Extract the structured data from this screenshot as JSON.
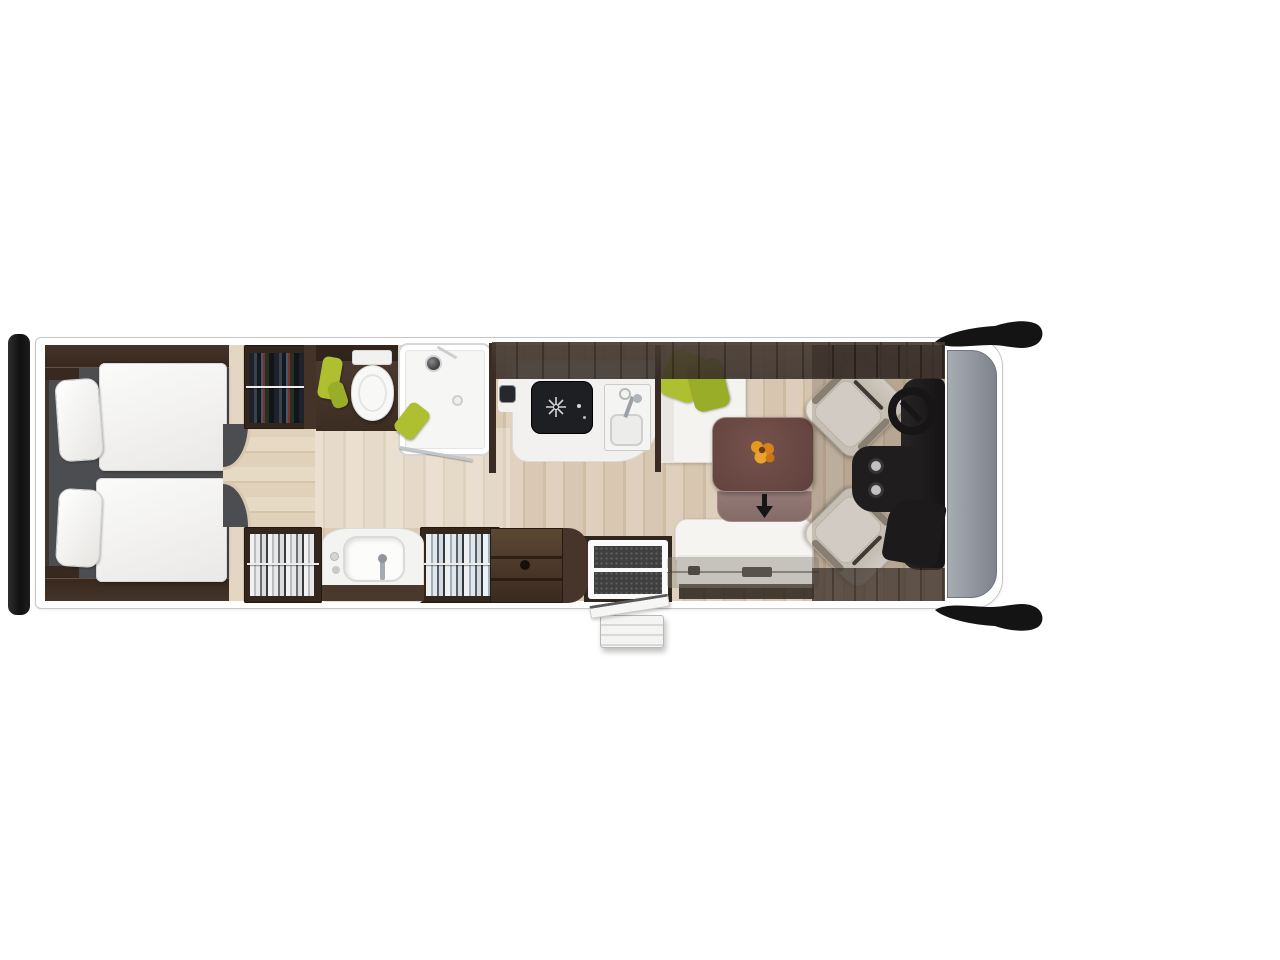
{
  "scene": {
    "name": "motorhome-floorplan-top-view",
    "type": "floorplan-rendering",
    "orientation": "vehicle front on the right, rear bumper on the left",
    "areas": [
      {
        "id": "rear-twin-bedroom",
        "fixtures": [
          "twin-bed-top",
          "twin-bed-bottom",
          "pillows",
          "curved-entry-step"
        ]
      },
      {
        "id": "wardrobes",
        "fixtures": [
          "hanging-clothes-top",
          "hanging-clothes-bottom-left",
          "hanging-clothes-bottom-right"
        ]
      },
      {
        "id": "bathroom",
        "fixtures": [
          "toilet",
          "corner-shower",
          "washbasin",
          "green-towels"
        ]
      },
      {
        "id": "kitchen",
        "fixtures": [
          "three-burner-hob",
          "sink-with-faucet",
          "overhead-lockers",
          "side-cabinet"
        ]
      },
      {
        "id": "dinette",
        "fixtures": [
          "l-shaped-bench",
          "green-cushions",
          "dining-table",
          "table-extension-leaf",
          "flower-bouquet",
          "forward-facing-travel-bench",
          "seatbelt-rail"
        ]
      },
      {
        "id": "cab",
        "fixtures": [
          "driver-swivel-seat",
          "passenger-swivel-seat",
          "steering-wheel",
          "dashboard",
          "center-console-cupholders",
          "windshield",
          "side-mirror-top",
          "side-mirror-bottom"
        ]
      },
      {
        "id": "entrance",
        "fixtures": [
          "entry-door-mat",
          "open-door-leaf",
          "exterior-folding-step"
        ]
      },
      {
        "id": "exterior",
        "fixtures": [
          "rear-bumper-bar"
        ]
      }
    ],
    "icons": [
      {
        "name": "arrow-down-icon",
        "meaning": "table sliding/extension direction"
      }
    ]
  },
  "palette": {
    "canvas": "#ffffff",
    "outline": "#c7c7c5",
    "wood": "#dccbb4",
    "woodDark": "#d2bfa5",
    "woodLight": "#e3d4bf",
    "walkwayWood": "#e0d1ba",
    "cabinetDark": "#43342a",
    "cabinetDarker": "#33261d",
    "bedroomFloor": "#4b4d50",
    "fixtureWhite": "#f4f3f0",
    "accentGreen": "#aec02f",
    "accentGreenDark": "#9aad28",
    "tableTop": "#5f413d",
    "tableLeaf": "#856b67",
    "flowerOrange": "#e59a1f",
    "jetBlack": "#121316",
    "windshieldGrey": "#7e838c",
    "windshieldLight": "#a7abb2",
    "matBlack": "#3e3f3e"
  }
}
